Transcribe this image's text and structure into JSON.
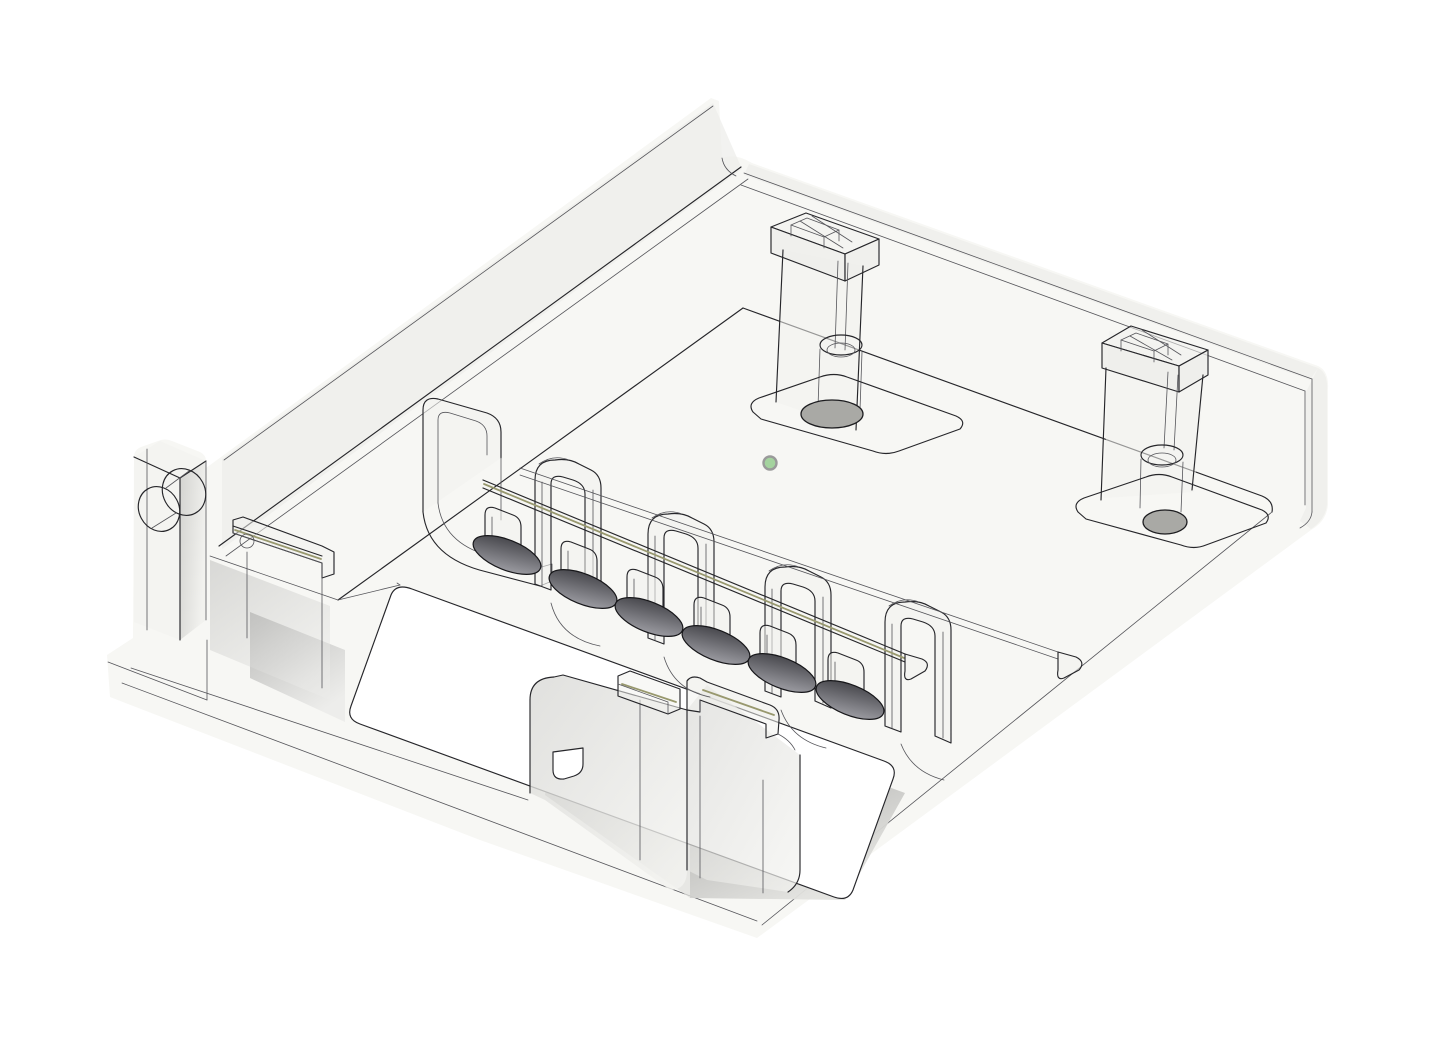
{
  "view": {
    "type": "3d-cad-model-viewport",
    "background": "#ffffff",
    "render_style": "translucent-wireframe"
  },
  "colors": {
    "line": "#26262a",
    "line_soft": "#55555a",
    "surface": "#f7f7f4",
    "surface_2": "#f0f0ec",
    "groove": "#98986e",
    "hole_gray": "#a9a9a5",
    "slot_a": "#46464b",
    "slot_b": "#8e8e92",
    "shadow_a": "#8f8f8d",
    "shadow_b": "#e2e2df",
    "origin_fill": "#a4d39e",
    "origin_ring": "#9a9a9a",
    "bg": "#ffffff"
  },
  "origin_marker": {
    "x": 770,
    "y": 463,
    "radius": 6.5
  },
  "model": {
    "part": "translucent-enclosure-base",
    "visible_features": {
      "mounting_boss_towers": 2,
      "boss_floor_holes": 2,
      "cable_clip_towers": 5,
      "clip_slot_openings": 6,
      "side_block_holes": 2,
      "floor_openings": 1,
      "guide_rails": 4,
      "tall_fin_wall": 1
    }
  }
}
